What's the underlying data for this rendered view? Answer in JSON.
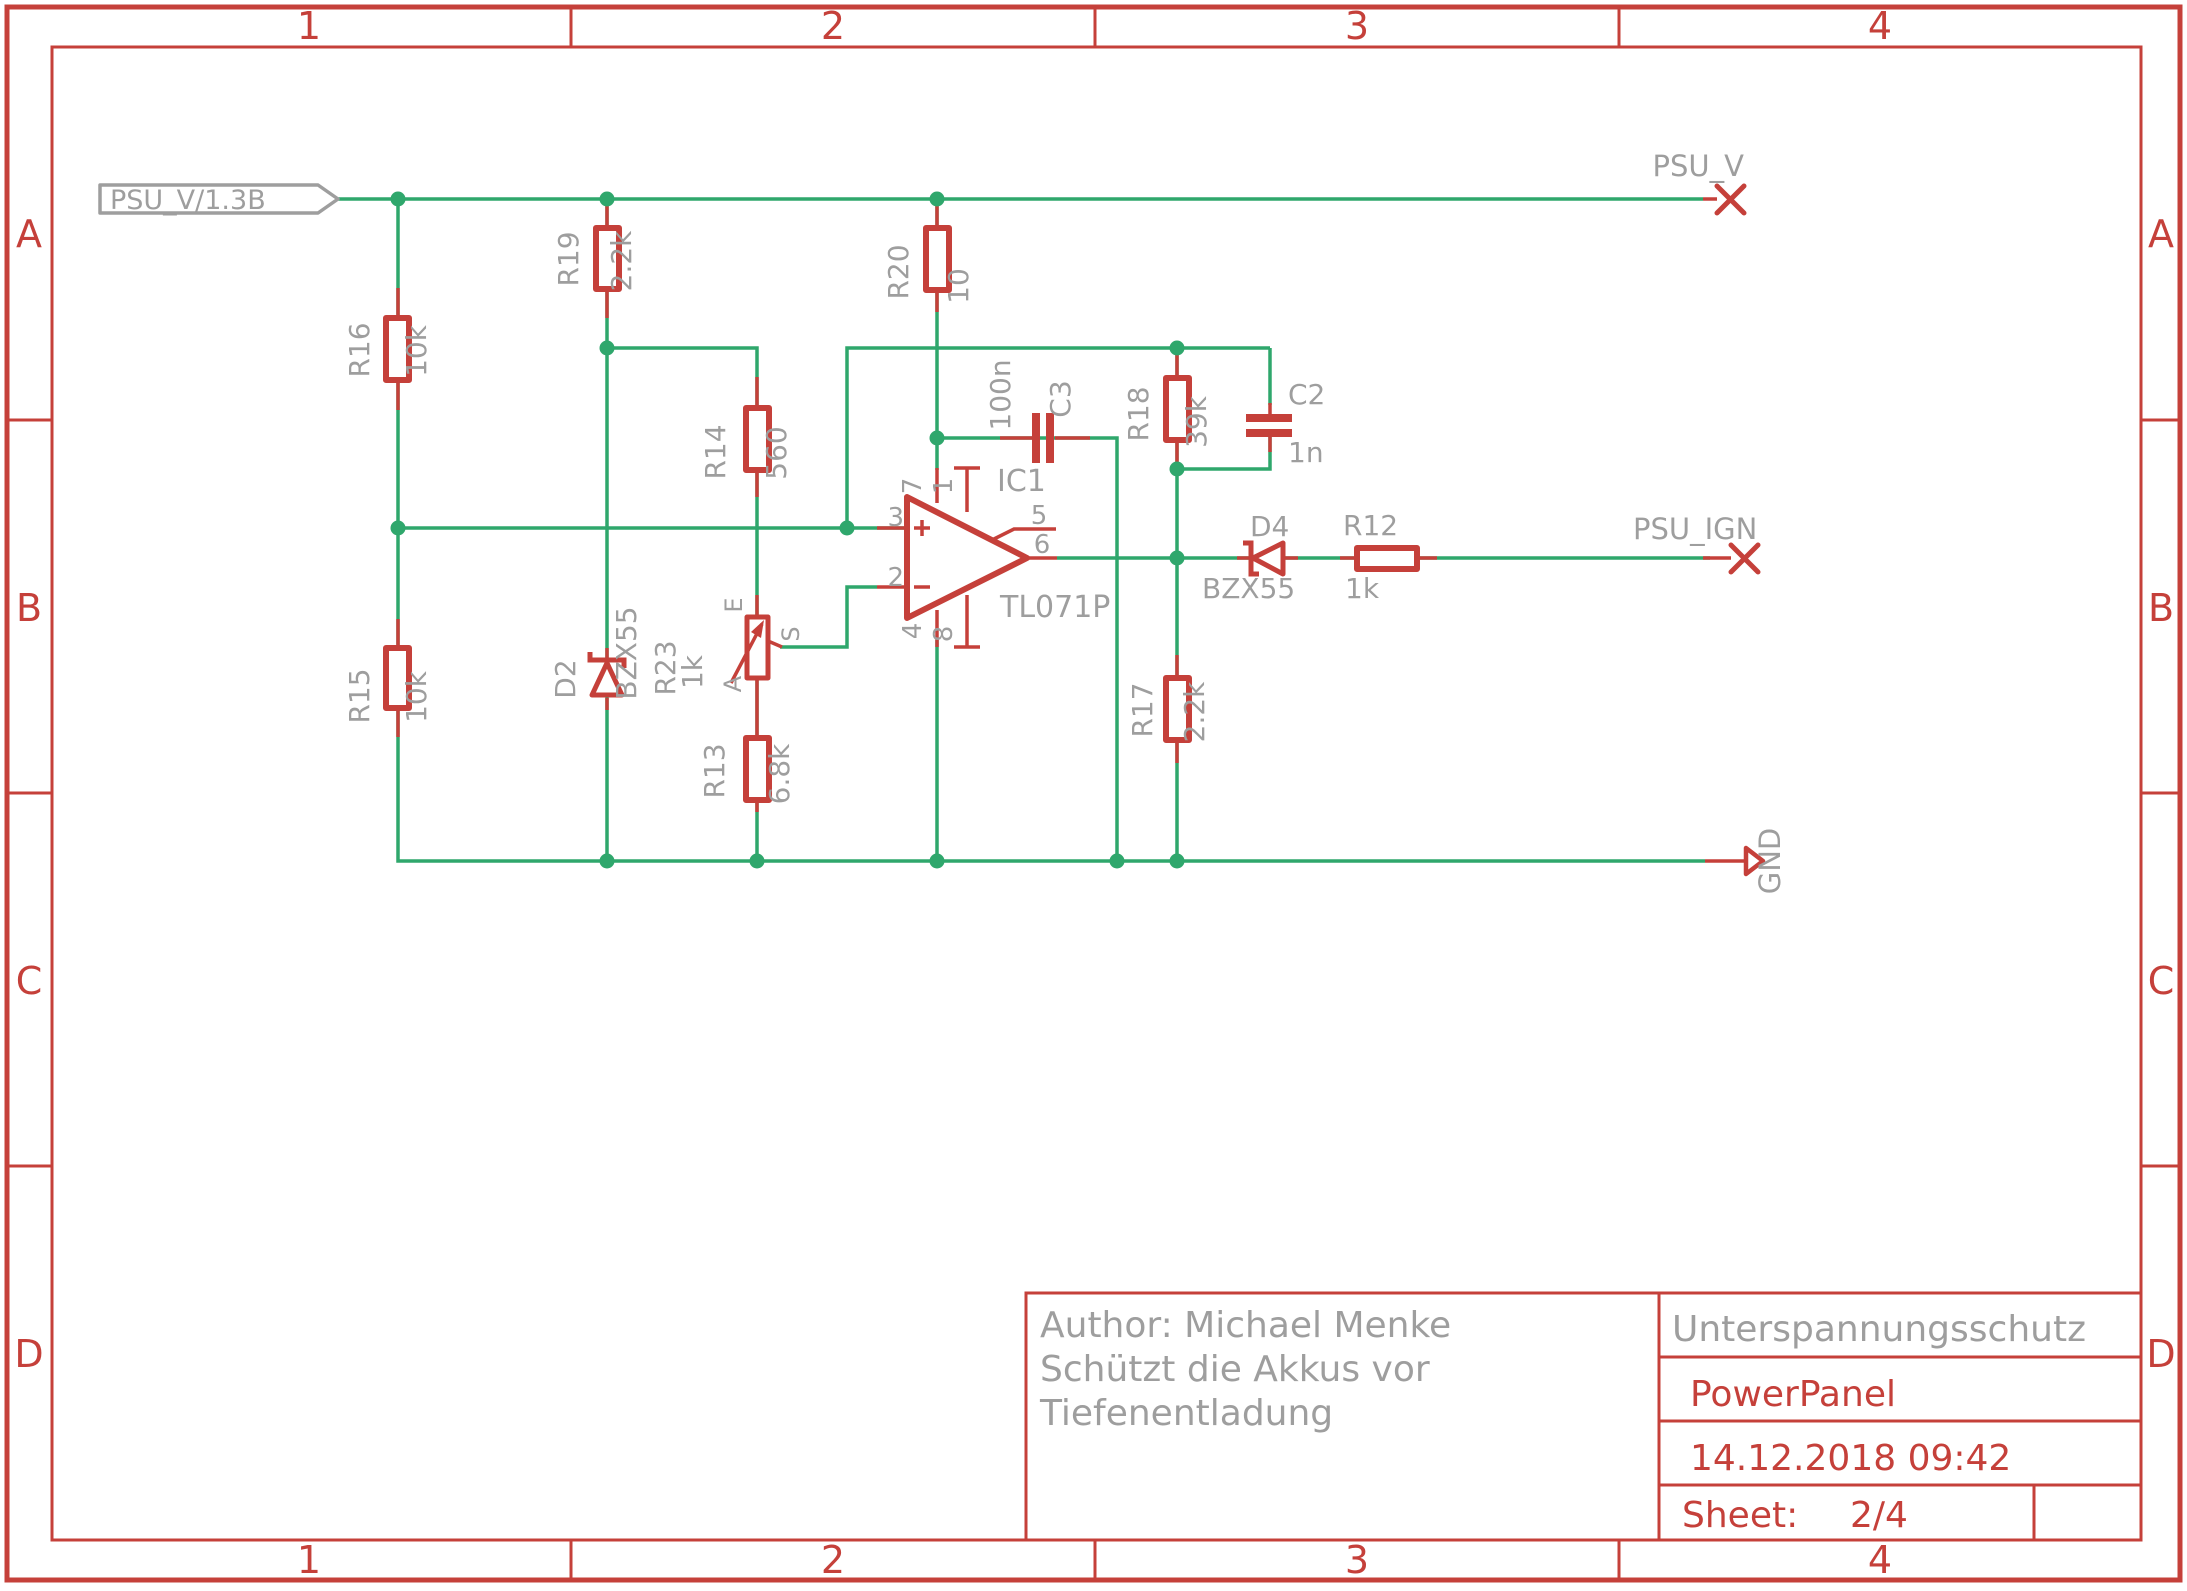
{
  "colors": {
    "wire_green": "#2fa76c",
    "symbol_red": "#c5403a",
    "label_gray": "#9e9e9e",
    "background": "#ffffff"
  },
  "frame": {
    "columns": [
      "1",
      "2",
      "3",
      "4"
    ],
    "rows": [
      "A",
      "B",
      "C",
      "D"
    ]
  },
  "title_block": {
    "author_line1": "Author: Michael Menke",
    "author_line2": "Schützt die Akkus vor",
    "author_line3": "Tiefenentladung",
    "project": "Unterspannungsschutz",
    "board": "PowerPanel",
    "date": "14.12.2018 09:42",
    "sheet_label": "Sheet:",
    "sheet_value": "2/4"
  },
  "net_labels": {
    "psu_v_flag": "PSU_V/1.3B",
    "psu_v": "PSU_V",
    "psu_ign": "PSU_IGN",
    "gnd": "GND"
  },
  "components": {
    "r12": {
      "name": "R12",
      "value": "1k"
    },
    "r13": {
      "name": "R13",
      "value": "6.8k"
    },
    "r14": {
      "name": "R14",
      "value": "560"
    },
    "r15": {
      "name": "R15",
      "value": "10k"
    },
    "r16": {
      "name": "R16",
      "value": "10k"
    },
    "r17": {
      "name": "R17",
      "value": "2.2k"
    },
    "r18": {
      "name": "R18",
      "value": "39k"
    },
    "r19": {
      "name": "R19",
      "value": "2.2k"
    },
    "r20": {
      "name": "R20",
      "value": "10"
    },
    "r23": {
      "name": "R23",
      "value": "1k",
      "pin_e": "E",
      "pin_s": "S",
      "pin_a": "A"
    },
    "d2": {
      "name": "D2",
      "value": "BZX55"
    },
    "d4": {
      "name": "D4",
      "value": "BZX55"
    },
    "c2": {
      "name": "C2",
      "value": "1n"
    },
    "c3": {
      "name": "C3",
      "value": "100n"
    },
    "ic1": {
      "name": "IC1",
      "value": "TL071P",
      "pin1": "1",
      "pin2": "2",
      "pin3": "3",
      "pin4": "4",
      "pin5": "5",
      "pin6": "6",
      "pin7": "7",
      "pin8": "8"
    }
  }
}
